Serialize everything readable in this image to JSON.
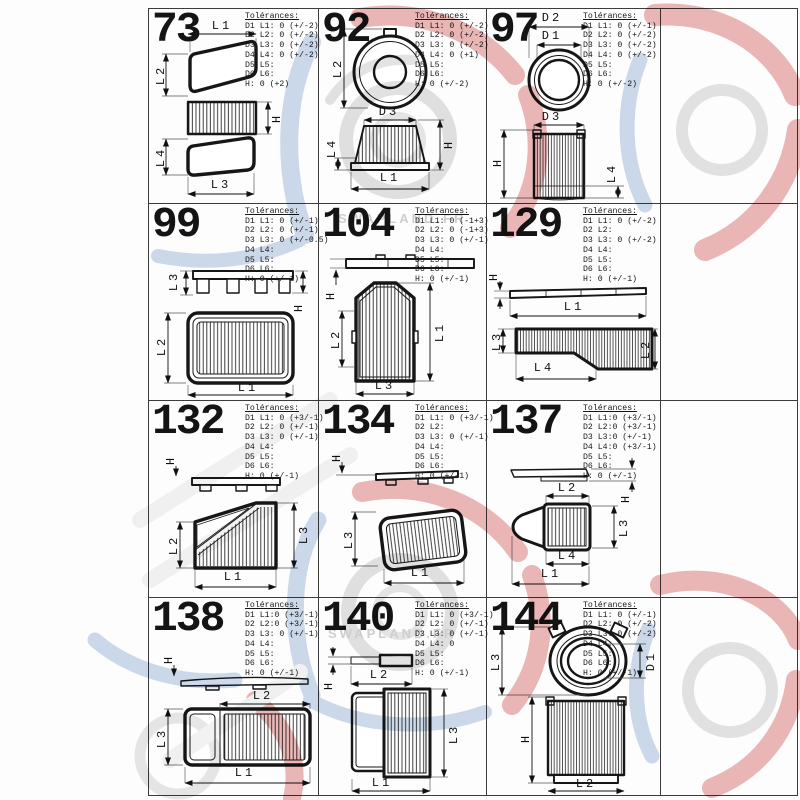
{
  "labels": {
    "tolerances_header": "Tolérances:"
  },
  "watermark": {
    "brand": "SWAPLAND.FR"
  },
  "cells": [
    {
      "number": "73",
      "tolerances": [
        "D1 L1: 0 (+/-2)",
        "D2 L2: 0 (+/-2)",
        "D3 L3: 0 (+/-2)",
        "D4 L4: 0 (+/-2)",
        "D5 L5:",
        "D6 L6:",
        "H: 0 (+2)"
      ],
      "dims": [
        "L1",
        "L2",
        "H",
        "L4",
        "L3"
      ]
    },
    {
      "number": "92",
      "tolerances": [
        "D1 L1: 0 (+/-2)",
        "D2 L2: 0 (+/-2)",
        "D3 L3: 0 (+/-2)",
        "D4 L4: 0 (+1)",
        "D5 L5:",
        "D6 L6:",
        "H: 0 (+/-2)"
      ],
      "dims": [
        "L2",
        "D3",
        "L4",
        "H",
        "L1"
      ]
    },
    {
      "number": "97",
      "tolerances": [
        "D1 L1: 0 (+/-1)",
        "D2 L2: 0 (+/-2)",
        "D3 L3: 0 (+/-2)",
        "D4 L4: 0 (+/-2)",
        "D5 L5:",
        "D6 L6:",
        "H: 0 (+/-2)"
      ],
      "dims": [
        "D2",
        "D1",
        "D3",
        "H",
        "L4"
      ]
    },
    {
      "number": "99",
      "tolerances": [
        "D1 L1: 0 (+/-1)",
        "D2 L2: 0 (+/-1)",
        "D3 L3: 0 (+/-0.5)",
        "D4 L4:",
        "D5 L5:",
        "D6 L6:",
        "H: 0 (+/-1)"
      ],
      "dims": [
        "L3",
        "H",
        "L2",
        "L1"
      ]
    },
    {
      "number": "104",
      "tolerances": [
        "D1 L1: 0 (-1+3)",
        "D2 L2: 0 (-1+3)",
        "D3 L3: 0 (+/-1)",
        "D4 L4:",
        "D5 L5:",
        "D6 L6:",
        "H: 0 (+/-1)"
      ],
      "dims": [
        "H",
        "L2",
        "L1",
        "L3"
      ]
    },
    {
      "number": "129",
      "tolerances": [
        "D1 L1: 0 (+/-2)",
        "D2 L2:",
        "D3 L3: 0 (+/-2)",
        "D4 L4:",
        "D5 L5:",
        "D6 L6:",
        "H: 0 (+/-1)"
      ],
      "dims": [
        "H",
        "L1",
        "L3",
        "L4",
        "L2"
      ]
    },
    {
      "number": "132",
      "tolerances": [
        "D1 L1: 0 (+3/-1)",
        "D2 L2: 0 (+/-1)",
        "D3 L3: 0 (+/-1)",
        "D4 L4:",
        "D5 L5:",
        "D6 L6:",
        "H: 0 (+/-1)"
      ],
      "dims": [
        "H",
        "L2",
        "L3",
        "L1"
      ]
    },
    {
      "number": "134",
      "tolerances": [
        "D1 L1: 0 (+3/-1)",
        "D2 L2:",
        "D3 L3: 0 (+/-1)",
        "D4 L4:",
        "D5 L5:",
        "D6 L6:",
        "H: 0 (+/-1)"
      ],
      "dims": [
        "H",
        "L3",
        "L1"
      ]
    },
    {
      "number": "137",
      "tolerances": [
        "D1 L1:0 (+3/-1)",
        "D2 L2:0 (+3/-1)",
        "D3 L3:0 (+/-1)",
        "D4 L4:0 (+3/-1)",
        "D5 L5:",
        "D6 L6:",
        "H: 0 (+/-1)"
      ],
      "dims": [
        "H",
        "L2",
        "L3",
        "L4",
        "L1"
      ]
    },
    {
      "number": "138",
      "tolerances": [
        "D1 L1:0 (+3/-1)",
        "D2 L2:0 (+3/-1)",
        "D3 L3: 0 (+/-1)",
        "D4 L4:",
        "D5 L5:",
        "D6 L6:",
        "H: 0 (+/-1)"
      ],
      "dims": [
        "H",
        "L2",
        "L3",
        "L1"
      ]
    },
    {
      "number": "140",
      "tolerances": [
        "D1 L1: 0 (+3/-1)",
        "D2 L2: 0 (+/-1)",
        "D3 L3: 0 (+/-1)",
        "D4 L4: 0",
        "D5 L5:",
        "D6 L6:",
        "H: 0 (+/-1)"
      ],
      "dims": [
        "H",
        "L2",
        "L3",
        "L1"
      ]
    },
    {
      "number": "144",
      "tolerances": [
        "D1 L1: 0 (+/-1)",
        "D2 L2: 0 (+/-2)",
        "D3 L3: 0 (+/-2)",
        "D4 L4:",
        "D5 L5:",
        "D6 L6:",
        "H: 0 (+/-1)"
      ],
      "dims": [
        "L3",
        "D1",
        "H",
        "L2"
      ]
    }
  ]
}
